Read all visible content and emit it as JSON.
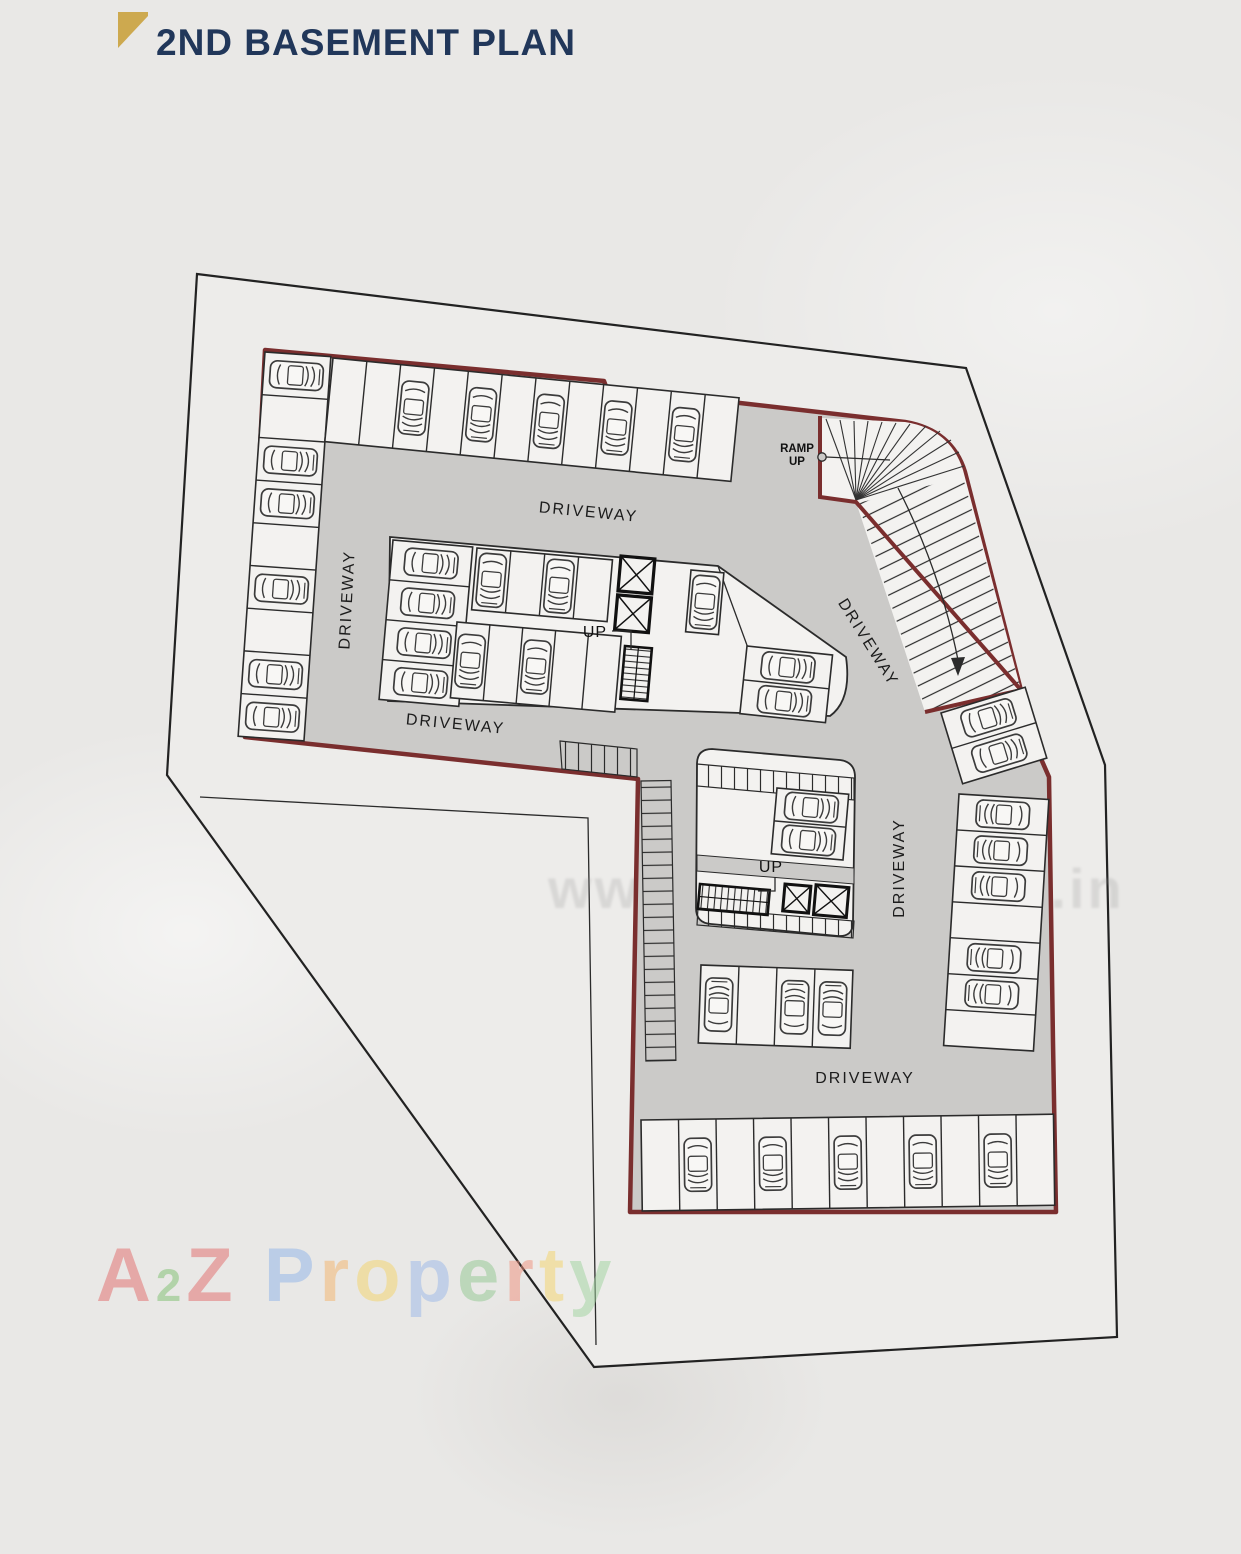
{
  "title": "2ND BASEMENT PLAN",
  "labels": {
    "driveway_top": "DRIVEWAY",
    "driveway_left": "DRIVEWAY",
    "driveway_lower_left": "DRIVEWAY",
    "driveway_ramp": "DRIVEWAY",
    "driveway_right": "DRIVEWAY",
    "driveway_bottom": "DRIVEWAY",
    "ramp_line1": "RAMP",
    "ramp_line2": "UP",
    "up_core_1": "UP",
    "up_core_2": "UP"
  },
  "watermarks": {
    "center": "www.a2zproperty.in",
    "brand_letters": [
      {
        "ch": "A",
        "color": "#e36a6a"
      },
      {
        "ch": "2",
        "color": "#7cbf6e",
        "small": true
      },
      {
        "ch": "Z",
        "color": "#e36a6a"
      },
      {
        "ch": " ",
        "color": "#888888"
      },
      {
        "ch": "P",
        "color": "#8fb3e8"
      },
      {
        "ch": "r",
        "color": "#f3b46a"
      },
      {
        "ch": "o",
        "color": "#f4d468"
      },
      {
        "ch": "p",
        "color": "#9ab8e8"
      },
      {
        "ch": "e",
        "color": "#90c890"
      },
      {
        "ch": "r",
        "color": "#f0907c"
      },
      {
        "ch": "t",
        "color": "#f4d468"
      },
      {
        "ch": "y",
        "color": "#9ed49e"
      }
    ]
  },
  "colors": {
    "wall_maroon": "#7a2e2e",
    "driveway_gray": "#cbcac8",
    "title_navy": "#21375a",
    "accent_gold": "#cda94f"
  },
  "parking": {
    "rows": [
      {
        "name": "left-column",
        "transform": "translate(265,352) rotate(4)",
        "dir": "h",
        "stallW": 66,
        "stallD": 42.8,
        "count": 9,
        "cars": [
          0,
          2,
          3,
          5,
          7,
          8
        ],
        "carRot": 90
      },
      {
        "name": "top-row",
        "transform": "translate(333,358) rotate(5.6)",
        "dir": "v",
        "stallW": 34,
        "stallD": 84,
        "count": 12,
        "cars": [
          2,
          4,
          6,
          8,
          10
        ],
        "carRot": 180
      },
      {
        "name": "mid-left-column",
        "transform": "translate(393,540) rotate(5)",
        "dir": "h",
        "stallW": 80,
        "stallD": 40,
        "count": 4,
        "cars": [
          0,
          1,
          2,
          3
        ],
        "carRot": 90
      },
      {
        "name": "mid-upper-row",
        "transform": "translate(477,548) rotate(5)",
        "dir": "v",
        "stallW": 34,
        "stallD": 62,
        "count": 4,
        "cars": [
          0,
          2
        ],
        "carRot": 180
      },
      {
        "name": "mid-lower-row",
        "transform": "translate(457,622) rotate(5)",
        "dir": "v",
        "stallW": 33,
        "stallD": 76,
        "count": 5,
        "cars": [
          0,
          2
        ],
        "carRot": 180
      },
      {
        "name": "mid-right-stall",
        "transform": "translate(691,570) rotate(5)",
        "dir": "v",
        "stallW": 33,
        "stallD": 62,
        "count": 1,
        "cars": [
          0
        ],
        "carRot": 180
      },
      {
        "name": "mid-diagonal-stalls",
        "transform": "translate(747,646) rotate(6)",
        "dir": "h",
        "stallW": 86,
        "stallD": 34,
        "count": 2,
        "cars": [
          0,
          1
        ],
        "carRot": 90
      },
      {
        "name": "lower-block-stalls",
        "transform": "translate(777,788) rotate(5)",
        "dir": "h",
        "stallW": 72,
        "stallD": 33,
        "count": 2,
        "cars": [
          0,
          1
        ],
        "carRot": 90
      },
      {
        "name": "island-row",
        "transform": "translate(701,965) rotate(2)",
        "dir": "v",
        "stallW": 38,
        "stallD": 78,
        "count": 4,
        "cars": [
          0,
          2,
          3
        ],
        "carRot": 0
      },
      {
        "name": "right-column",
        "transform": "translate(959,794) rotate(3.5)",
        "dir": "h",
        "stallW": 90,
        "stallD": 36,
        "count": 7,
        "cars": [
          0,
          1,
          2,
          4,
          5
        ],
        "carRot": -90
      },
      {
        "name": "ramp-foot-stalls",
        "transform": "translate(941,713) rotate(-17)",
        "dir": "h",
        "stallW": 88,
        "stallD": 37,
        "count": 2,
        "cars": [
          0,
          1
        ],
        "carRot": 90
      },
      {
        "name": "bottom-row",
        "transform": "translate(641,1120) rotate(-0.8)",
        "dir": "v",
        "stallW": 37.5,
        "stallD": 91,
        "count": 11,
        "cars": [
          1,
          3,
          5,
          7,
          9
        ],
        "carRot": 180
      }
    ]
  }
}
